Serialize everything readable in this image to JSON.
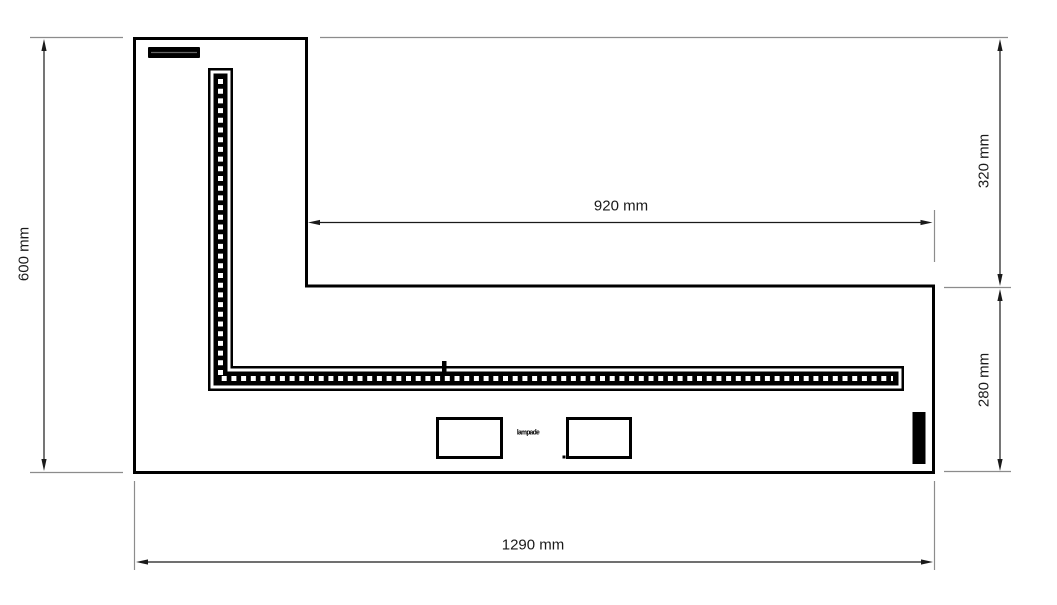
{
  "diagram": {
    "dimensions": {
      "left_height": "600 mm",
      "inner_top_width": "920 mm",
      "right_upper_height": "320 mm",
      "right_lower_height": "280 mm",
      "bottom_width": "1290 mm"
    },
    "annotation": "lampade",
    "colors": {
      "background": "#ffffff",
      "outline": "#000000",
      "strip": "#000000",
      "dimension_line": "#1a1a1a",
      "extension_line": "#8c8c8c",
      "text": "#1a1a1a"
    }
  }
}
